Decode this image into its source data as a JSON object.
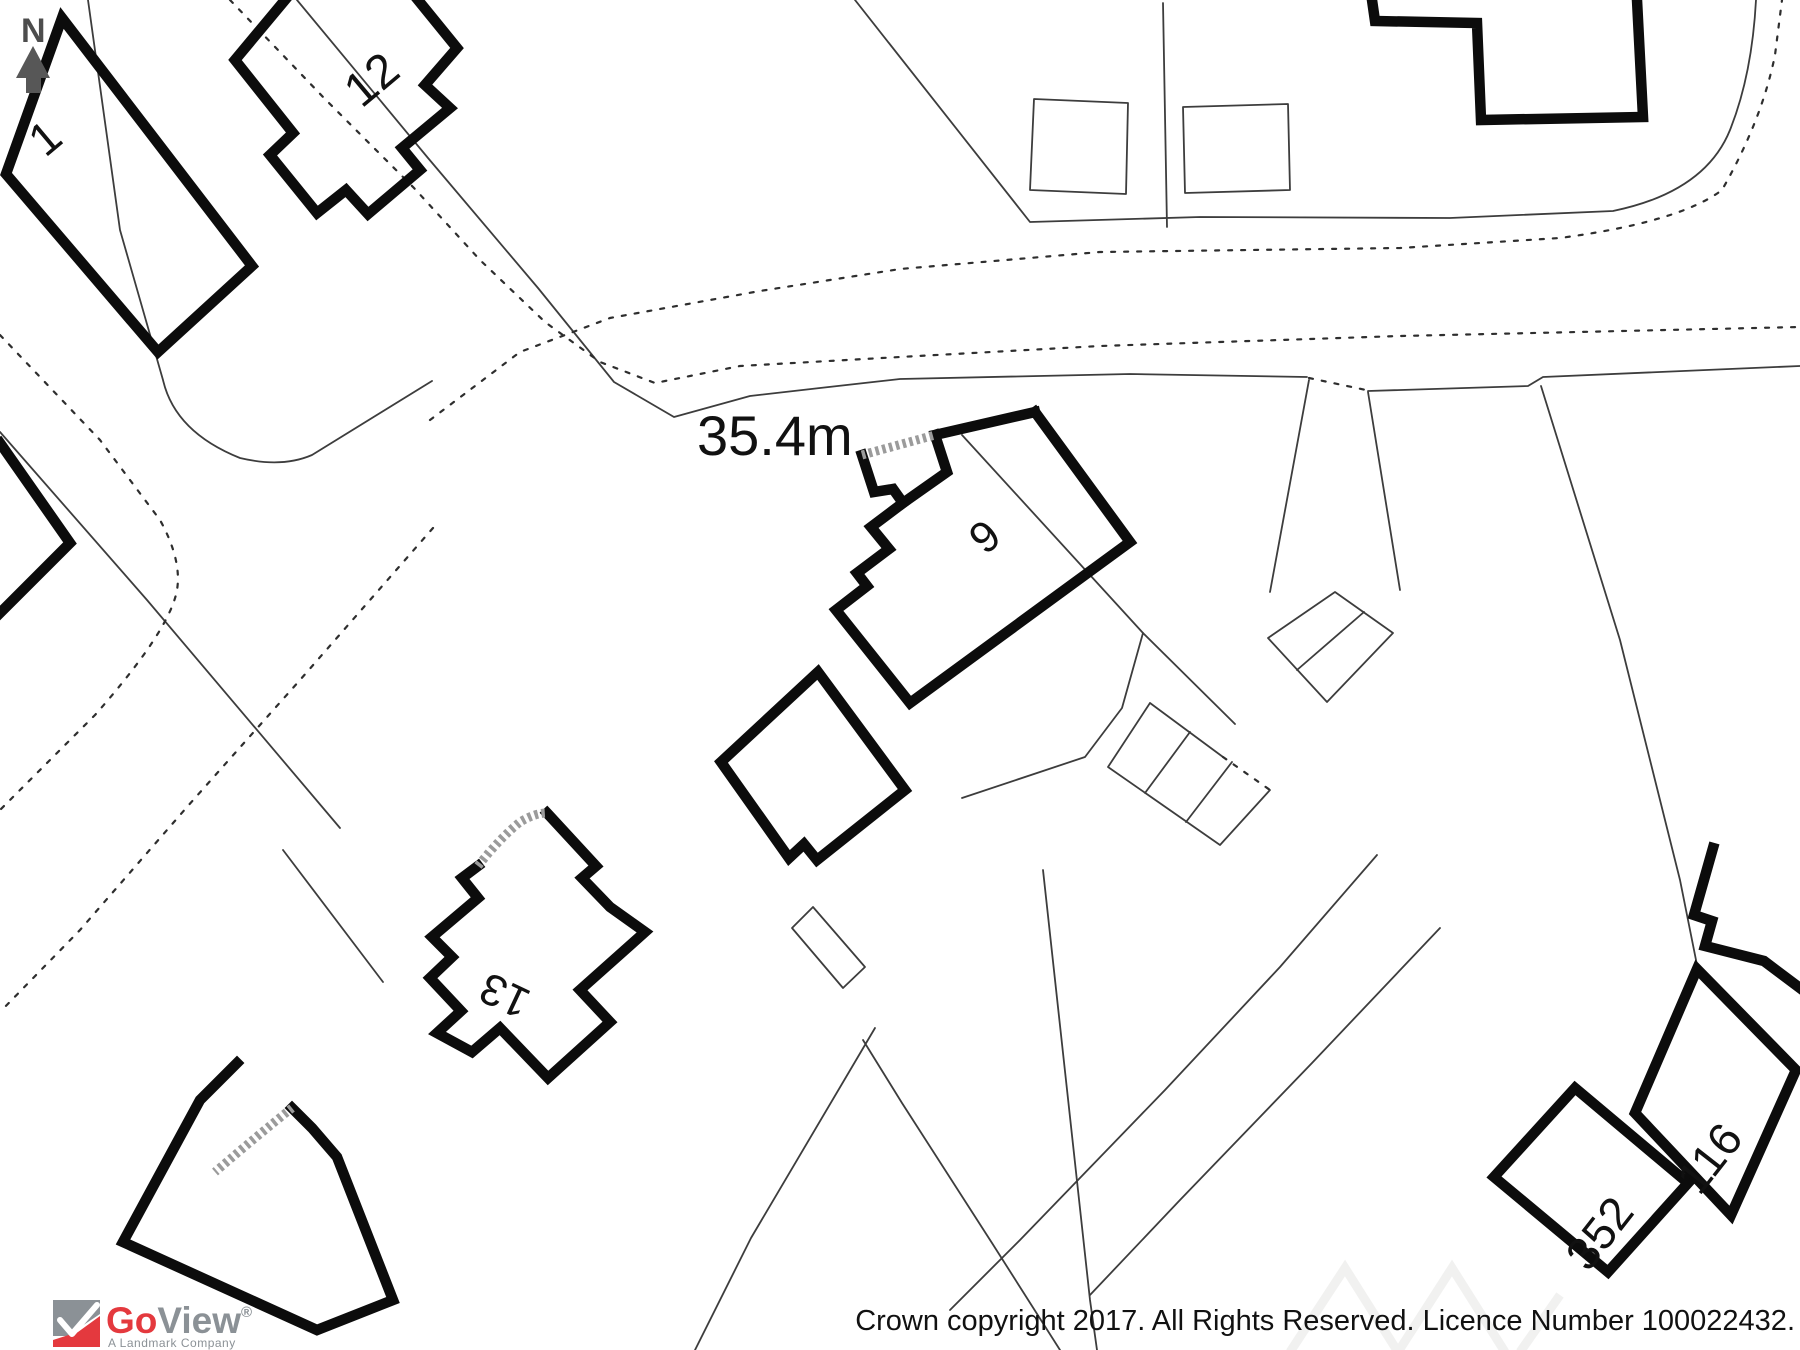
{
  "map": {
    "measurement_label": "35.4m",
    "north_label": "N",
    "house_numbers": {
      "n1": "1",
      "n12": "12",
      "n6": "6",
      "n13": "13",
      "n352": "352",
      "n116": "116"
    }
  },
  "logo": {
    "go": "Go",
    "view": "View",
    "registered": "®",
    "tagline": "A Landmark Company"
  },
  "footer": {
    "copyright": "Crown copyright 2017. All Rights Reserved. Licence Number 100022432."
  },
  "colors": {
    "boundary_red": "#e11a1e",
    "cross_red": "#cf2b2b",
    "building_black": "#0c0c0c",
    "logo_red": "#e4393e",
    "logo_gray": "#8b9196",
    "north_gray": "#4d4d4d"
  }
}
